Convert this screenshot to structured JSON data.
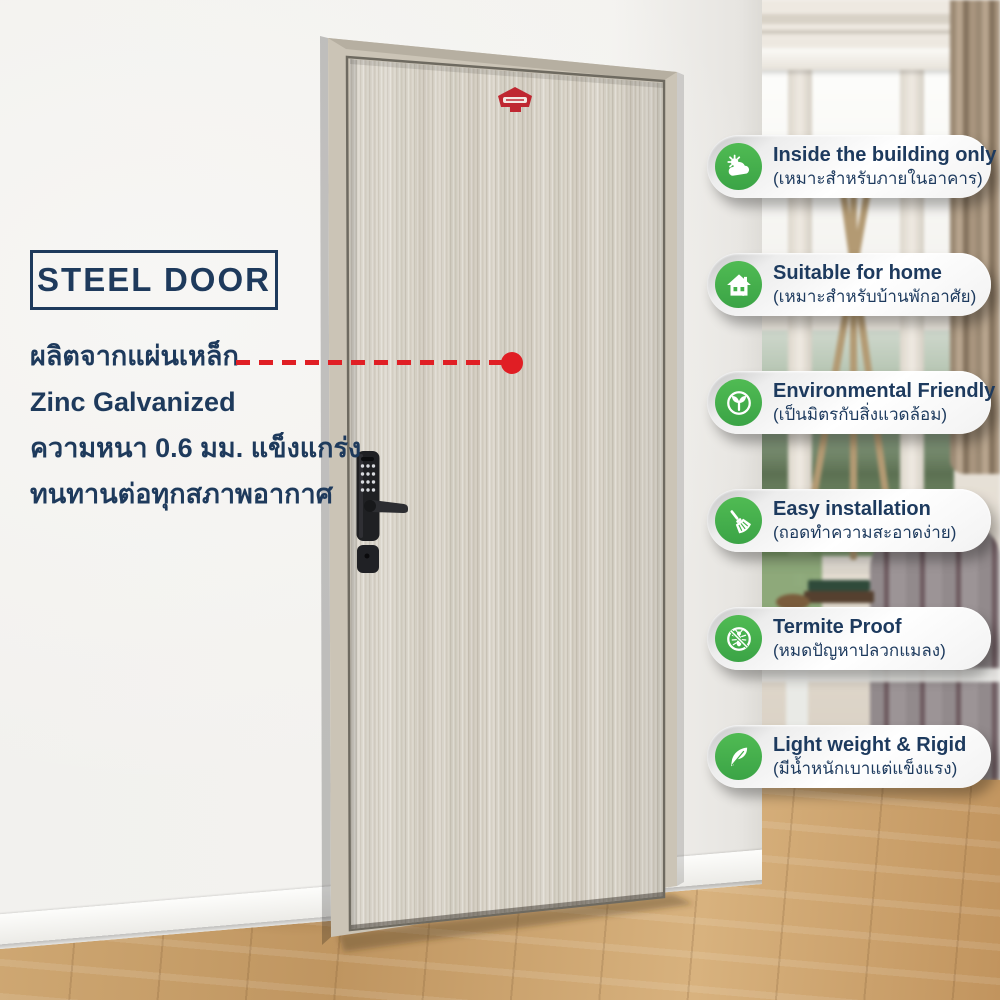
{
  "page": {
    "type": "steel-door-product-infographic"
  },
  "title_box": {
    "label": "STEEL DOOR"
  },
  "description": {
    "lines": [
      "ผลิตจากแผ่นเหล็ก",
      "Zinc Galvanized",
      "ความหนา 0.6 มม. แข็งแกร่ง",
      "ทนทานต่อทุกสภาพอากาศ"
    ]
  },
  "features": [
    {
      "icon": "sun-cloud-icon",
      "label_en": "Inside the building only",
      "label_th": "(เหมาะสำหรับภายในอาคาร)"
    },
    {
      "icon": "house-icon",
      "label_en": "Suitable for home",
      "label_th": "(เหมาะสำหรับบ้านพักอาศัย)"
    },
    {
      "icon": "sprout-icon",
      "label_en": "Environmental Friendly",
      "label_th": "(เป็นมิตรกับสิ่งแวดล้อม)"
    },
    {
      "icon": "broom-icon",
      "label_en": "Easy installation",
      "label_th": "(ถอดทำความสะอาดง่าย)"
    },
    {
      "icon": "no-termite-icon",
      "label_en": "Termite Proof",
      "label_th": "(หมดปัญหาปลวกแมลง)"
    },
    {
      "icon": "feather-icon",
      "label_en": "Light weight & Rigid",
      "label_th": "(มีน้ำหนักเบาแต่แข็งแรง)"
    }
  ],
  "door": {
    "badge_icon": "brand-badge-icon",
    "lock_icon": "digital-lock-icon"
  },
  "colors": {
    "accent_navy": "#1e3a5c",
    "accent_green": "#43b14a",
    "accent_red": "#e01e24",
    "badge_red": "#bf2731",
    "frame_greige": "#cbc4b6",
    "door_wood": "#d9d4c9",
    "floor_wood": "#c49a63"
  }
}
